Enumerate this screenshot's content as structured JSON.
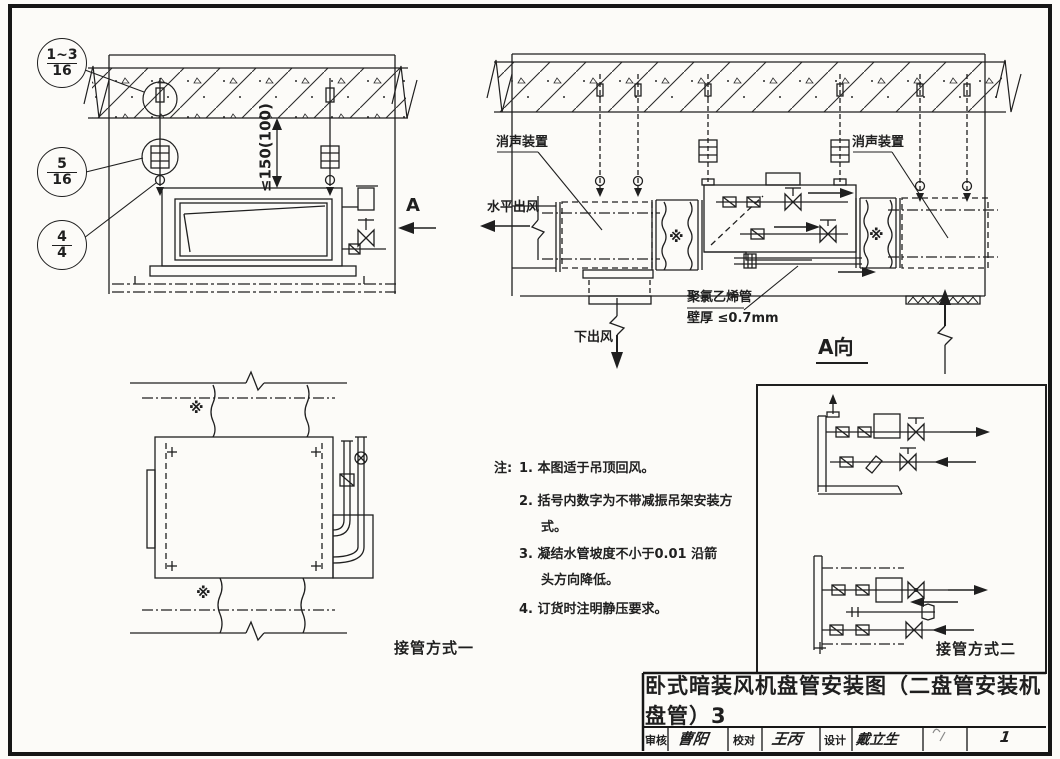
{
  "palette": {
    "ink": "#1f1f1f",
    "paper": "#fcfbf8"
  },
  "section_left": {
    "bubbles": [
      {
        "top": "1~3",
        "bottom": "16"
      },
      {
        "top": "5",
        "bottom": "16"
      },
      {
        "top": "4",
        "bottom": "4"
      }
    ],
    "dimension_label": "≤150(100)",
    "view_arrow_label": "A"
  },
  "section_right": {
    "silencer_left_label": "消声装置",
    "silencer_right_label": "消声装置",
    "horizontal_outlet_label": "水平出风",
    "down_outlet_label": "下出风",
    "pvc_line1": "聚氯乙烯管",
    "pvc_line2": "壁厚 ≤0.7mm",
    "view_label": "A向",
    "canvas_joint_symbol": "※"
  },
  "plan_view": {
    "caption": "接管方式一",
    "canvas_joint_symbol": "※"
  },
  "detail_view": {
    "caption": "接管方式二"
  },
  "notes": {
    "label": "注:",
    "rows": [
      {
        "no": "1.",
        "text": "本图适于吊顶回风。"
      },
      {
        "no": "2.",
        "text": "括号内数字为不带减振吊架安装方"
      },
      {
        "no": "",
        "text": "式。"
      },
      {
        "no": "3.",
        "text": "凝结水管坡度不小于0.01 沿箭"
      },
      {
        "no": "",
        "text": "头方向降低。"
      },
      {
        "no": "4.",
        "text": "订货时注明静压要求。"
      }
    ]
  },
  "title_block": {
    "title": "卧式暗装风机盘管安装图（二盘管安装机盘管）3",
    "cells": [
      {
        "label": "审核",
        "value": "曹阳"
      },
      {
        "label": "校对",
        "value": "王丙"
      },
      {
        "label": "设计",
        "value": "戴立生"
      }
    ],
    "page_number": "1"
  }
}
